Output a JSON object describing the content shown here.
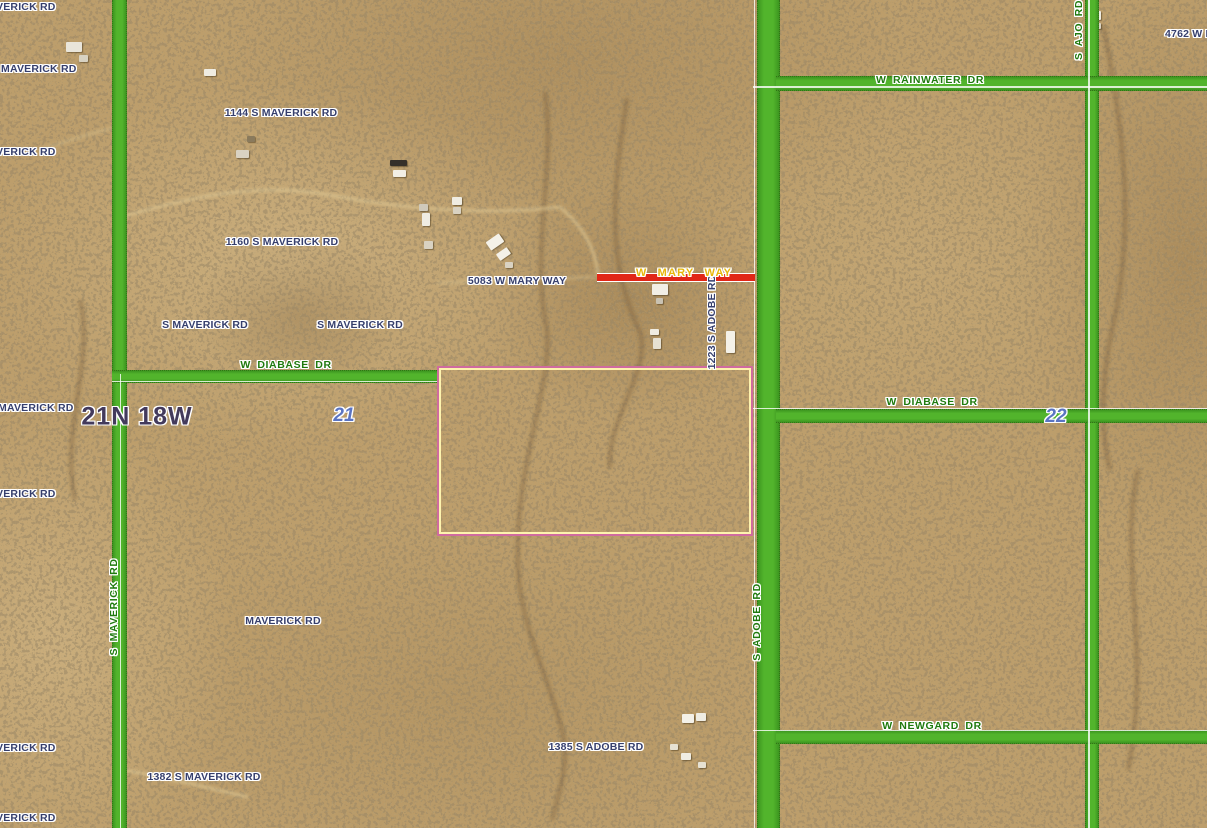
{
  "map": {
    "viewport": {
      "width": 1207,
      "height": 828
    },
    "township_range": "21N 18W",
    "section_numbers": [
      "21",
      "22"
    ],
    "colors": {
      "terrain_base": "#bd9e6b",
      "road_green": "#52b42c",
      "road_green_edge": "#3d9620",
      "road_label_green": "#1f7a0e",
      "address_navy": "#363f6d",
      "mary_way_gold": "#e7b709",
      "township_purple": "#433a5c",
      "section_blue": "#5a74c2",
      "red_segment": "#e12717",
      "parcel_outer_pink": "#cf6b9f",
      "parcel_inner_yellow": "#fdf3ae",
      "boundary_white": "rgba(255,255,255,0.8)"
    },
    "roads": [
      {
        "name": "S MAVERICK RD",
        "orient": "v",
        "x": 112,
        "y": 0,
        "w": 13,
        "h": 828
      },
      {
        "name": "S ADOBE RD",
        "orient": "v",
        "x": 757,
        "y": 0,
        "w": 21,
        "h": 828
      },
      {
        "name": "S AJO RD",
        "orient": "v",
        "x": 1085,
        "y": 0,
        "w": 12,
        "h": 828
      },
      {
        "name": "W DIABASE DR WEST",
        "orient": "h",
        "x": 112,
        "y": 370,
        "w": 325,
        "h": 11
      },
      {
        "name": "W RAINWATER DR",
        "orient": "h",
        "x": 776,
        "y": 76,
        "w": 431,
        "h": 13
      },
      {
        "name": "W DIABASE DR EAST",
        "orient": "h",
        "x": 776,
        "y": 409,
        "w": 431,
        "h": 12
      },
      {
        "name": "W NEWGARD DR",
        "orient": "h",
        "x": 776,
        "y": 730,
        "w": 431,
        "h": 12
      }
    ],
    "boundary_lines": [
      {
        "o": "v",
        "x": 119.5,
        "y": 374,
        "len": 454
      },
      {
        "o": "v",
        "x": 753.5,
        "y": 0,
        "len": 828
      },
      {
        "o": "v",
        "x": 1088,
        "y": 0,
        "len": 828
      },
      {
        "o": "h",
        "x": 753,
        "y": 86,
        "len": 454
      },
      {
        "o": "h",
        "x": 112,
        "y": 380.5,
        "len": 325
      },
      {
        "o": "h",
        "x": 753,
        "y": 407.5,
        "len": 454
      },
      {
        "o": "h",
        "x": 753,
        "y": 729.5,
        "len": 454
      }
    ],
    "mary_way_segment": {
      "x": 597,
      "y": 272.5,
      "w": 158,
      "h": 9
    },
    "selected_parcel": {
      "x": 437,
      "y": 366,
      "w": 316,
      "h": 170
    },
    "labels": [
      {
        "text": "VERICK RD",
        "x": -4,
        "y": 1,
        "kind": "address",
        "anchor": "tl"
      },
      {
        "text": "MAVERICK RD",
        "x": 1,
        "y": 63,
        "kind": "address",
        "anchor": "tl"
      },
      {
        "text": "VERICK RD",
        "x": -4,
        "y": 146,
        "kind": "address",
        "anchor": "tl"
      },
      {
        "text": "MAVERICK RD",
        "x": -2,
        "y": 402,
        "kind": "address",
        "anchor": "tl"
      },
      {
        "text": "VERICK RD",
        "x": -4,
        "y": 488,
        "kind": "address",
        "anchor": "tl"
      },
      {
        "text": "VERICK RD",
        "x": -4,
        "y": 742,
        "kind": "address",
        "anchor": "tl"
      },
      {
        "text": "VERICK RD",
        "x": -4,
        "y": 812,
        "kind": "address",
        "anchor": "tl"
      },
      {
        "text": "1144 S MAVERICK RD",
        "x": 281,
        "y": 113,
        "kind": "address"
      },
      {
        "text": "1160 S MAVERICK RD",
        "x": 282,
        "y": 242,
        "kind": "address"
      },
      {
        "text": "S MAVERICK RD",
        "x": 205,
        "y": 325,
        "kind": "address"
      },
      {
        "text": "S MAVERICK RD",
        "x": 360,
        "y": 325,
        "kind": "address"
      },
      {
        "text": "5083 W MARY WAY",
        "x": 517,
        "y": 281,
        "kind": "address"
      },
      {
        "text": "1223 S ADOBE RD",
        "x": 712,
        "y": 322,
        "kind": "address",
        "rot": true
      },
      {
        "text": "MAVERICK RD",
        "x": 283,
        "y": 621,
        "kind": "address"
      },
      {
        "text": "1382 S MAVERICK RD",
        "x": 204,
        "y": 777,
        "kind": "address"
      },
      {
        "text": "1385 S ADOBE RD",
        "x": 596,
        "y": 747,
        "kind": "address"
      },
      {
        "text": "4762 W R",
        "x": 1165,
        "y": 28,
        "kind": "address",
        "anchor": "tl"
      },
      {
        "text": "W DIABASE DR",
        "x": 286,
        "y": 365,
        "kind": "road"
      },
      {
        "text": "W RAINWATER DR",
        "x": 930,
        "y": 80,
        "kind": "road"
      },
      {
        "text": "W DIABASE DR",
        "x": 932,
        "y": 402,
        "kind": "road"
      },
      {
        "text": "W NEWGARD DR",
        "x": 932,
        "y": 726,
        "kind": "road"
      },
      {
        "text": "S MAVERICK RD",
        "x": 114,
        "y": 607,
        "kind": "road",
        "rot": true
      },
      {
        "text": "S ADOBE RD",
        "x": 757,
        "y": 622,
        "kind": "road",
        "rot": true
      },
      {
        "text": "S AJO RD",
        "x": 1079,
        "y": 30,
        "kind": "road",
        "rot": true
      },
      {
        "text": "W MARY WAY",
        "x": 684,
        "y": 273,
        "kind": "highway"
      },
      {
        "text": "21N 18W",
        "x": 137,
        "y": 417,
        "kind": "township"
      },
      {
        "text": "21",
        "x": 344,
        "y": 416,
        "kind": "section"
      },
      {
        "text": "22",
        "x": 1056,
        "y": 417,
        "kind": "section"
      }
    ],
    "buildings": [
      {
        "x": 66,
        "y": 42,
        "w": 16,
        "h": 10,
        "c": "#e9e5da"
      },
      {
        "x": 79,
        "y": 55,
        "w": 9,
        "h": 7,
        "c": "#d8d2c2"
      },
      {
        "x": 204,
        "y": 69,
        "w": 12,
        "h": 7,
        "c": "#efece2"
      },
      {
        "x": 236,
        "y": 150,
        "w": 13,
        "h": 8,
        "c": "#d9d2c2"
      },
      {
        "x": 247,
        "y": 136,
        "w": 8,
        "h": 6,
        "c": "#8a7a5c"
      },
      {
        "x": 390,
        "y": 160,
        "w": 17,
        "h": 6,
        "c": "#35302a"
      },
      {
        "x": 393,
        "y": 170,
        "w": 13,
        "h": 7,
        "c": "#f2efe6"
      },
      {
        "x": 419,
        "y": 204,
        "w": 9,
        "h": 7,
        "c": "#cfc9ba"
      },
      {
        "x": 422,
        "y": 213,
        "w": 8,
        "h": 13,
        "c": "#efece2"
      },
      {
        "x": 424,
        "y": 241,
        "w": 9,
        "h": 8,
        "c": "#d9d2c2"
      },
      {
        "x": 452,
        "y": 197,
        "w": 10,
        "h": 8,
        "c": "#efece2"
      },
      {
        "x": 453,
        "y": 207,
        "w": 8,
        "h": 7,
        "c": "#d9d2c2"
      },
      {
        "x": 487,
        "y": 237,
        "w": 16,
        "h": 10,
        "c": "#f4f1e8",
        "r": -35
      },
      {
        "x": 497,
        "y": 250,
        "w": 13,
        "h": 8,
        "c": "#f4f1e8",
        "r": -35
      },
      {
        "x": 505,
        "y": 262,
        "w": 8,
        "h": 6,
        "c": "#d9d2c2"
      },
      {
        "x": 652,
        "y": 284,
        "w": 16,
        "h": 11,
        "c": "#f2efe6"
      },
      {
        "x": 656,
        "y": 298,
        "w": 7,
        "h": 6,
        "c": "#c9c2b2"
      },
      {
        "x": 650,
        "y": 329,
        "w": 9,
        "h": 6,
        "c": "#efece2"
      },
      {
        "x": 653,
        "y": 338,
        "w": 8,
        "h": 11,
        "c": "#e6e1d3"
      },
      {
        "x": 726,
        "y": 331,
        "w": 9,
        "h": 22,
        "c": "#f4f1e8"
      },
      {
        "x": 1087,
        "y": 11,
        "w": 14,
        "h": 9,
        "c": "#efece2"
      },
      {
        "x": 1093,
        "y": 23,
        "w": 8,
        "h": 6,
        "c": "#d9d2c2"
      },
      {
        "x": 682,
        "y": 714,
        "w": 12,
        "h": 9,
        "c": "#f4f1e8"
      },
      {
        "x": 696,
        "y": 713,
        "w": 10,
        "h": 8,
        "c": "#efece2"
      },
      {
        "x": 670,
        "y": 744,
        "w": 8,
        "h": 6,
        "c": "#e6e1d3"
      },
      {
        "x": 681,
        "y": 753,
        "w": 10,
        "h": 7,
        "c": "#f0ede3"
      },
      {
        "x": 698,
        "y": 762,
        "w": 8,
        "h": 6,
        "c": "#e6e1d3"
      }
    ]
  }
}
